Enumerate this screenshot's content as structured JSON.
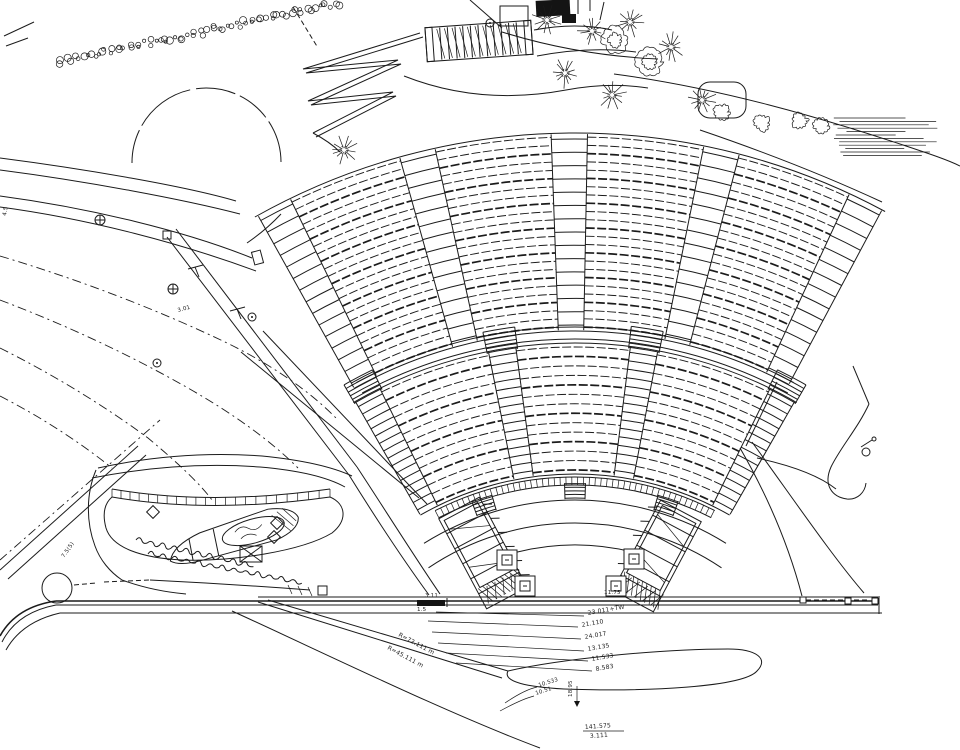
{
  "drawing": {
    "type": "amphitheater-site-plan",
    "background": "#ffffff",
    "ink": "#1b1b1b"
  },
  "annotations": [
    {
      "text": "23.011+TW",
      "x": 588,
      "y": 615,
      "rot": -10,
      "s": 6
    },
    {
      "text": "21.110",
      "x": 582,
      "y": 627,
      "rot": -10,
      "s": 6
    },
    {
      "text": "24.017",
      "x": 585,
      "y": 639,
      "rot": -10,
      "s": 6
    },
    {
      "text": "13.135",
      "x": 588,
      "y": 651,
      "rot": -10,
      "s": 6
    },
    {
      "text": "11.533",
      "x": 592,
      "y": 661,
      "rot": -10,
      "s": 6
    },
    {
      "text": "8.583",
      "x": 596,
      "y": 671,
      "rot": -10,
      "s": 6
    },
    {
      "text": "18.95",
      "x": 572,
      "y": 697,
      "rot": -90,
      "s": 5.5
    },
    {
      "text": "3.11",
      "x": 425,
      "y": 597,
      "rot": 0,
      "s": 5.5
    },
    {
      "text": "1.5",
      "x": 417,
      "y": 611,
      "rot": 0,
      "s": 5.5
    },
    {
      "text": "11.75",
      "x": 604,
      "y": 594,
      "rot": 0,
      "s": 5.5
    },
    {
      "text": "R=72.111 m",
      "x": 398,
      "y": 636,
      "rot": 28,
      "s": 6
    },
    {
      "text": "R=45.111 m",
      "x": 387,
      "y": 649,
      "rot": 28,
      "s": 6
    },
    {
      "text": "10.533",
      "x": 539,
      "y": 687,
      "rot": -18,
      "s": 5.5
    },
    {
      "text": "10.51",
      "x": 536,
      "y": 695,
      "rot": -18,
      "s": 5.5
    },
    {
      "text": "141.575",
      "x": 585,
      "y": 729,
      "rot": -4,
      "s": 6
    },
    {
      "text": "3.111",
      "x": 590,
      "y": 738,
      "rot": -4,
      "s": 6
    },
    {
      "text": "7.5(5)",
      "x": 64,
      "y": 558,
      "rot": -55,
      "s": 5.5
    },
    {
      "text": "3.01",
      "x": 178,
      "y": 312,
      "rot": -15,
      "s": 5.5
    },
    {
      "text": "4.5",
      "x": 6,
      "y": 216,
      "rot": -80,
      "s": 5.5
    }
  ],
  "plan": {
    "center": {
      "x": 575,
      "y": 785
    },
    "upper_tier": {
      "r_inner": 458,
      "r_outer": 648,
      "rows": 24,
      "aisles": [
        117.5,
        104,
        90.5,
        77,
        63.5
      ],
      "aisle_half_deg": 1.6
    },
    "lower_tier": {
      "r_inner": 315,
      "r_outer": 438,
      "rows": 14,
      "aisles": [
        118,
        99.5,
        81,
        62
      ],
      "aisle_half_deg": 1.8
    },
    "cross_aisle": {
      "radii": [
        446,
        458
      ],
      "a0": 118.5,
      "a1": 61.5
    },
    "front_wall": {
      "r_inner": 300,
      "r_outer": 308,
      "a0": 117,
      "a1": 63,
      "tick_step": 1.1,
      "stair_angles": [
        108,
        90,
        72
      ]
    },
    "walkway_arcs": [
      {
        "r": 285,
        "a0": 122,
        "a1": 58
      },
      {
        "r": 262,
        "a0": 124,
        "a1": 56
      },
      {
        "r": 240,
        "a0": 104,
        "a1": 76
      }
    ],
    "stage_stairs": [
      {
        "cx": 483,
        "cy": 553,
        "rot": -28,
        "w": 46,
        "h": 102,
        "tick_side": 1
      },
      {
        "cx": 657,
        "cy": 556,
        "rot": 28,
        "w": 46,
        "h": 102,
        "tick_side": -1
      }
    ],
    "column_bases": [
      [
        507,
        560
      ],
      [
        525,
        586
      ],
      [
        634,
        559
      ],
      [
        616,
        586
      ]
    ],
    "lamp_symbols": [
      [
        100,
        220
      ],
      [
        173,
        289
      ]
    ],
    "point_symbols": [
      [
        252,
        317
      ],
      [
        157,
        363
      ],
      [
        490,
        23
      ]
    ],
    "circles": [
      {
        "x": 866,
        "y": 452,
        "r": 4
      },
      {
        "x": 874,
        "y": 439,
        "r": 2
      },
      {
        "x": 57,
        "y": 588,
        "r": 15
      }
    ],
    "diamonds": [
      [
        153,
        512
      ],
      [
        277,
        523
      ],
      [
        274,
        537
      ]
    ],
    "trees_spiky": [
      [
        547,
        20
      ],
      [
        592,
        31
      ],
      [
        630,
        22
      ],
      [
        565,
        73
      ],
      [
        612,
        95
      ],
      [
        671,
        47
      ],
      [
        702,
        100
      ],
      [
        344,
        150
      ]
    ],
    "trees_round": [
      [
        650,
        62
      ],
      [
        615,
        40
      ]
    ],
    "shrubs": [
      [
        762,
        123
      ],
      [
        800,
        121
      ],
      [
        821,
        126
      ],
      [
        722,
        112
      ]
    ],
    "hedge": {
      "x0": 58,
      "y0": 62,
      "x1": 338,
      "y1": 4,
      "n": 72
    },
    "hatch_patch": {
      "x": 833,
      "y": 118,
      "rows": 12,
      "dy": 3.4,
      "min": 58,
      "max": 100
    },
    "stone_band": {
      "a": [
        112,
        489
      ],
      "c": [
        210,
        506
      ],
      "b": [
        330,
        489
      ],
      "a2": [
        112,
        497
      ],
      "c2": [
        210,
        514
      ],
      "b2": [
        330,
        497
      ],
      "n": 22
    },
    "zigzag": {
      "pts": [
        [
          420,
          33
        ],
        [
          303,
          69
        ],
        [
          398,
          60
        ],
        [
          308,
          101
        ],
        [
          393,
          92
        ],
        [
          313,
          133
        ]
      ],
      "dx": 3,
      "dy": 4
    },
    "stairs_top": {
      "cx": 479,
      "cy": 41,
      "rot": -4,
      "w": 106,
      "h": 34,
      "steps": 12
    },
    "scribbles": [
      {
        "x": 136,
        "y": 540,
        "n": 10,
        "rot": 8
      },
      {
        "x": 148,
        "y": 554,
        "n": 13,
        "rot": 6
      }
    ],
    "rects": [
      {
        "x": 536,
        "y": 0,
        "w": 34,
        "h": 16,
        "cls": "f",
        "rot": -3
      },
      {
        "x": 562,
        "y": 14,
        "w": 14,
        "h": 9,
        "cls": "f"
      },
      {
        "x": 500,
        "y": 6,
        "w": 28,
        "h": 20,
        "cls": "s"
      },
      {
        "x": 698,
        "y": 82,
        "w": 48,
        "h": 36,
        "cls": "s",
        "rx": 12
      },
      {
        "x": 417,
        "y": 600,
        "w": 28,
        "h": 6,
        "cls": "f"
      },
      {
        "x": 800,
        "y": 597,
        "w": 6,
        "h": 6,
        "cls": "sw"
      },
      {
        "x": 845,
        "y": 598,
        "w": 6,
        "h": 6,
        "cls": "sw"
      },
      {
        "x": 872,
        "y": 598,
        "w": 6,
        "h": 6,
        "cls": "sw"
      },
      {
        "x": 163,
        "y": 231,
        "w": 8,
        "h": 8,
        "cls": "s"
      },
      {
        "x": 253,
        "y": 251,
        "w": 9,
        "h": 13,
        "cls": "s",
        "rot": -15
      },
      {
        "x": 318,
        "y": 586,
        "w": 9,
        "h": 9,
        "cls": "s"
      }
    ],
    "paths": [
      {
        "d": "M0 158 C85 169 185 186 236 201",
        "cls": "s"
      },
      {
        "d": "M0 170 C85 181 182 199 240 214",
        "cls": "s"
      },
      {
        "d": "M0 196 C90 208 185 231 252 258",
        "cls": "s"
      },
      {
        "d": "M0 207 C90 219 183 244 256 271",
        "cls": "s"
      },
      {
        "d": "M247 243 Q266 230 281 214",
        "cls": "s"
      },
      {
        "d": "M167 237 L349 475",
        "cls": "s"
      },
      {
        "d": "M176 229 L357 467",
        "cls": "s"
      },
      {
        "d": "M419 498 L241 352",
        "cls": "s"
      },
      {
        "d": "M427 504 L263 331",
        "cls": "s"
      },
      {
        "d": "M0 256 Q120 292 225 342 Q295 376 338 420",
        "cls": "dd"
      },
      {
        "d": "M0 300 Q100 338 188 388 Q258 428 298 468",
        "cls": "dd"
      },
      {
        "d": "M0 348 Q80 388 148 438 Q196 478 212 500",
        "cls": "dd"
      },
      {
        "d": "M0 396 Q62 428 112 468",
        "cls": "dd"
      },
      {
        "d": "M0 560 L160 420",
        "cls": "dd"
      },
      {
        "d": "M0 570 L138 446",
        "cls": "s"
      },
      {
        "d": "M8 579 L146 455",
        "cls": "s"
      },
      {
        "d": "M98 468 Q180 450 262 456 Q322 462 352 476",
        "cls": "s"
      },
      {
        "d": "M92 478 Q178 461 260 467 Q318 472 345 487",
        "cls": "s"
      },
      {
        "d": "M96 470 C86 494 86 522 95 546 C100 560 110 572 122 580",
        "cls": "s"
      },
      {
        "d": "M349 475 C372 512 402 558 429 595",
        "cls": "s"
      },
      {
        "d": "M357 467 C382 505 414 556 440 594",
        "cls": "s"
      },
      {
        "d": "M112 497 Q210 514 330 497 C346 504 348 520 332 533 C302 551 232 562 182 560 C142 558 112 548 106 528 C102 513 105 503 112 497 Z",
        "cls": "s"
      },
      {
        "d": "M112 489 Q210 506 330 489",
        "cls": "s"
      },
      {
        "d": "M240 546 h22 v16 h-22 z M240 546 l22 16 M262 546 l-22 16",
        "cls": "s"
      },
      {
        "d": "M122 580 Q152 591 186 594",
        "cls": "s"
      },
      {
        "d": "M258 597 H878",
        "cls": "s"
      },
      {
        "d": "M56 601 H878",
        "cls": "s2"
      },
      {
        "d": "M56 605 H878",
        "cls": "s"
      },
      {
        "d": "M60 613 H882",
        "cls": "s"
      },
      {
        "d": "M56 601 C28 605 10 618 0 636",
        "cls": "s2"
      },
      {
        "d": "M56 605 C30 610 12 622 2 642",
        "cls": "s"
      },
      {
        "d": "M60 613 C34 619 16 632 6 650",
        "cls": "s"
      },
      {
        "d": "M806 600 H870",
        "cls": "d"
      },
      {
        "d": "M447 598 V607",
        "cls": "s"
      },
      {
        "d": "M879 596 V614",
        "cls": "s"
      },
      {
        "d": "M258 602 L502 678",
        "cls": "s"
      },
      {
        "d": "M268 600 L508 671",
        "cls": "s"
      },
      {
        "d": "M508 671 C560 659 660 649 728 649 C757 649 769 659 757 671 C743 687 648 692 564 689 C528 687 502 682 508 671 Z",
        "cls": "s"
      },
      {
        "d": "M232 611 C320 651 444 712 540 748",
        "cls": "s"
      },
      {
        "d": "M436 612 L584 616",
        "cls": "h"
      },
      {
        "d": "M428 621 L578 627",
        "cls": "h"
      },
      {
        "d": "M432 632 L581 639",
        "cls": "h"
      },
      {
        "d": "M438 643 L584 651",
        "cls": "h"
      },
      {
        "d": "M446 653 L588 661",
        "cls": "h"
      },
      {
        "d": "M456 663 L592 671",
        "cls": "h"
      },
      {
        "d": "M505 703 Q524 690 537 687",
        "cls": "h"
      },
      {
        "d": "M500 711 Q522 699 534 696",
        "cls": "h"
      },
      {
        "d": "M577 686 V701",
        "cls": "h"
      },
      {
        "d": "M574 701 h6 l-3 6 z",
        "cls": "f"
      },
      {
        "d": "M583 731 H624",
        "cls": "h"
      },
      {
        "d": "M869 404 C858 428 840 448 831 467 C823 485 832 497 847 499 C858 500 865 492 866 483",
        "cls": "s"
      },
      {
        "d": "M869 404 L853 366",
        "cls": "s"
      },
      {
        "d": "M861 447 L872 440",
        "cls": "s"
      },
      {
        "d": "M757 458 Q812 470 836 489",
        "cls": "s"
      },
      {
        "d": "M740 448 C770 500 790 550 802 596",
        "cls": "s"
      },
      {
        "d": "M752 442 C792 497 832 556 864 593",
        "cls": "s"
      },
      {
        "d": "M777 382 L746 446",
        "cls": "s"
      },
      {
        "d": "M4 36 L34 22",
        "cls": "s"
      },
      {
        "d": "M6 46 L28 38",
        "cls": "s"
      },
      {
        "d": "M293 7 L318 48",
        "cls": "d"
      },
      {
        "d": "M132 163 A74 74 0 0 1 281 162",
        "cls": "c"
      },
      {
        "d": "M534 30 Q576 22 612 30",
        "cls": "s"
      },
      {
        "d": "M537 56 Q590 46 636 52",
        "cls": "s"
      },
      {
        "d": "M404 76 Q480 106 566 90 Q610 82 648 88",
        "cls": "s"
      },
      {
        "d": "M313 133 Q330 142 340 152",
        "cls": "s"
      },
      {
        "d": "M470 0 L502 28",
        "cls": "s"
      },
      {
        "d": "M578 0 V14",
        "cls": "s"
      },
      {
        "d": "M590 0 V11",
        "cls": "s"
      },
      {
        "d": "M604 2 L600 20",
        "cls": "s"
      },
      {
        "d": "M502 32 C560 50 612 57 658 59",
        "cls": "s"
      },
      {
        "d": "M614 74 C720 88 822 118 906 146 C930 154 948 160 960 166",
        "cls": "s"
      },
      {
        "d": "M700 130 Q800 164 882 202",
        "cls": "s"
      },
      {
        "d": "M188 269 L203 265",
        "cls": "s"
      },
      {
        "d": "M195 267 L199 277",
        "cls": "s"
      },
      {
        "d": "M230 311 L245 307",
        "cls": "s"
      },
      {
        "d": "M237 309 L241 319",
        "cls": "s"
      },
      {
        "d": "M74 585 L96 583",
        "cls": "d"
      },
      {
        "d": "M104 582 L150 580",
        "cls": "d"
      },
      {
        "d": "M150 580 Q230 584 310 590",
        "cls": "s"
      },
      {
        "d": "M288 585 L292 594 M298 586 L302 595 M308 587 L312 596",
        "cls": "h"
      },
      {
        "d": "M-70 6 Q-64 -8 -34 -13 L38 -17 Q62 -13 65 -1 Q63 11 38 15 L-38 14 Q-62 14 -70 6 Z",
        "cls": "s",
        "tf": "translate(236 536) rotate(-16)"
      },
      {
        "d": "M-46 -10 L-48 12",
        "cls": "s",
        "tf": "translate(236 536) rotate(-16)"
      },
      {
        "d": "M-20 -13 L-22 14",
        "cls": "s",
        "tf": "translate(236 536) rotate(-16)"
      },
      {
        "d": "M-14 0 a32 12 0 1 0 64 0 a32 12 0 1 0 -64 0",
        "cls": "s",
        "tf": "translate(236 536) rotate(-16)"
      },
      {
        "d": "M0 -4 q8 -6 14 0 q6 6 14 0 M4 4 q8 -5 16 1",
        "cls": "h",
        "tf": "translate(236 536) rotate(-16)"
      },
      {
        "d": "M40 -10 l14 20 M46 -12 l12 18 M52 -14 l10 16",
        "cls": "h",
        "tf": "translate(236 536) rotate(-16)"
      }
    ]
  }
}
